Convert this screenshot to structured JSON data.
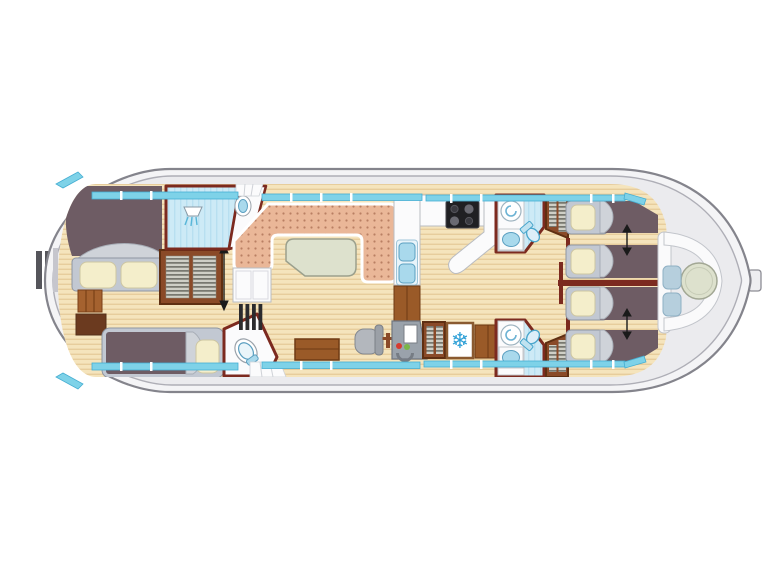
{
  "diagram": {
    "type": "boat-floor-plan",
    "subject": "top-down deck plan of a canal houseboat with aft cabin, salon, galley, helm, two fore bathrooms, four sliding single berths and a bow seating deck",
    "visible_text": "none"
  },
  "icons": {
    "snowflake": "❄",
    "snowflake_meaning": "refrigerator",
    "double_arrow_meaning": "berths slide together / adjustable"
  },
  "rooms": [
    {
      "name": "stern-swim-platform",
      "items": [
        "boarding-rails"
      ]
    },
    {
      "name": "aft-cabin",
      "items": [
        "double-bed",
        "single-bed",
        "wardrobe",
        "steps",
        "sideboard-low"
      ]
    },
    {
      "name": "aft-shower-room",
      "items": [
        "shower"
      ]
    },
    {
      "name": "aft-entry-vestibule",
      "items": [
        "washbasin",
        "entry-steps"
      ]
    },
    {
      "name": "aft-toilet-room",
      "items": [
        "toilet"
      ]
    },
    {
      "name": "salon",
      "items": [
        "u-shaped-sofa",
        "dining-table",
        "sideboard",
        "companionway-steps",
        "desk"
      ]
    },
    {
      "name": "galley",
      "items": [
        "double-sink",
        "tall-unit",
        "worktop",
        "stove-four-burner",
        "breakfast-bar",
        "lower-cabinet"
      ]
    },
    {
      "name": "helm-station",
      "items": [
        "helm-seat",
        "steering-pedestal",
        "instrument-console",
        "shelved-cabinet",
        "refrigerator",
        "counter"
      ]
    },
    {
      "name": "fore-bathroom-port",
      "items": [
        "shower-tray",
        "washbasin",
        "toilet",
        "wardrobe"
      ]
    },
    {
      "name": "fore-cabin-port",
      "items": [
        "single-berth",
        "single-berth",
        "slide-together-arrow"
      ]
    },
    {
      "name": "fore-cabin-starboard",
      "items": [
        "single-berth",
        "single-berth",
        "slide-together-arrow"
      ]
    },
    {
      "name": "fore-bathroom-starboard",
      "items": [
        "shower-tray",
        "washbasin",
        "toilet",
        "wardrobe"
      ]
    },
    {
      "name": "bow-deck",
      "items": [
        "curved-bench",
        "round-table",
        "seat-cushion",
        "seat-cushion"
      ]
    }
  ],
  "berth_count": {
    "aft_double": 1,
    "aft_single": 1,
    "fore_singles": 4
  },
  "colors": {
    "bg": "#ffffff",
    "hull-fill": "#f4f4f6",
    "hull-stroke": "#84848c",
    "deck": "#ebebee",
    "wall": "#7c2a1f",
    "wood-a": "#f5e4bc",
    "wood-b": "#e7cd9c",
    "window-cyan": "#7ed2e8",
    "window-stroke": "#45aed2",
    "sofa": "#eab798",
    "sofa-dot": "#b97f63",
    "table-green": "#dde1cd",
    "mattress": "#6e5c64",
    "bed-frame": "#c2c8d2",
    "pillow": "#f4eecb",
    "blanket-fold": "#cfd3d9",
    "bath-floor": "#cdeaf6",
    "fixture-blue": "#a9d9ec",
    "fixture-stroke": "#5b9fc0",
    "wardrobe-brown": "#8a4a28",
    "cabinet-brown": "#9a5a28",
    "dark-brown": "#6b3a1f",
    "console-gray": "#9aa2ab",
    "indicator-red": "#d63b2f",
    "indicator-green": "#7ab648",
    "fridge-icon-blue": "#2d9fd6"
  }
}
